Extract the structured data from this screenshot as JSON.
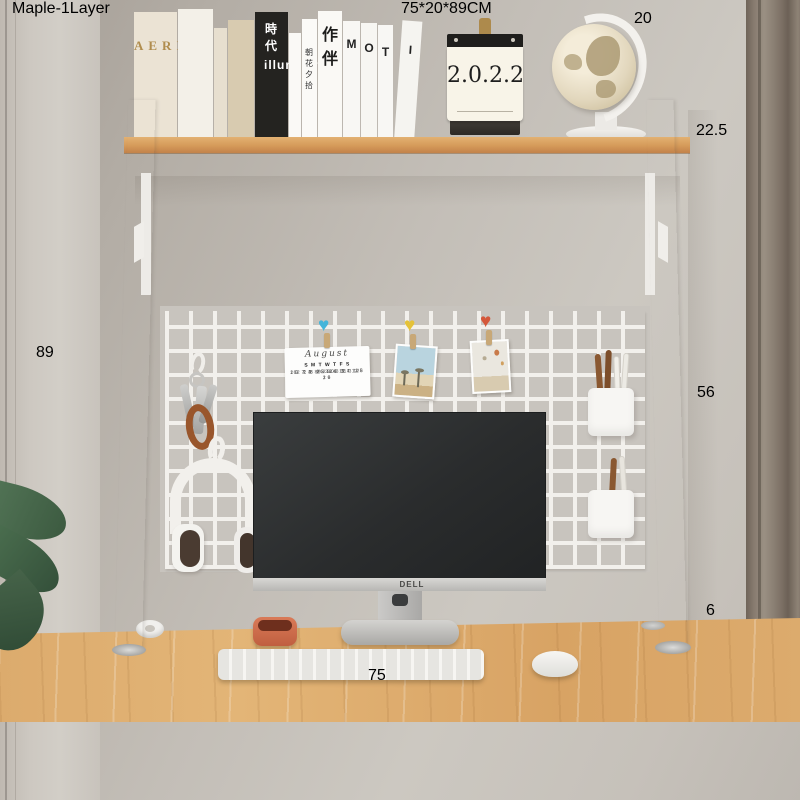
{
  "banner": {
    "variant_label": "Maple-1Layer",
    "size_label": "75*20*89CM"
  },
  "dimensions": {
    "width": "75",
    "depth": "20",
    "total_height": "89",
    "upper_height": "22.5",
    "middle_height": "56",
    "foot_height": "6"
  },
  "shelf_items": {
    "monitor_brand": "DELL",
    "desk_calendar_year": "2.0.2.2",
    "books": {
      "aerin": "AERIN",
      "black_spine_cjk": "時代",
      "black_spine_latin": "illuminate",
      "zhaohua": "朝花夕拾",
      "zuoban": "作伴",
      "letter_m": "M",
      "letter_o": "O",
      "letter_t": "T",
      "letter_i": "I"
    }
  },
  "grid_calendar": {
    "month": "August",
    "days_header": "S M T W T F S",
    "weeks": [
      "1 2 3 4 5",
      "6 7 8 9 10 11 12",
      "13 14 15 16 17 18 19",
      "20 21 22 23 24 25 26",
      "27 28 29 30 31"
    ]
  },
  "colors": {
    "banner_blue": "#2f6aa4",
    "dimension_blue": "#2b5f93",
    "heart_clip_blue": "#45b5da",
    "heart_clip_yellow": "#e5c238",
    "heart_clip_red": "#d4573a",
    "desk_wood": "#dcab6d",
    "shelf_wood_edge": "#cf9455",
    "frame_white": "#f6f5f2"
  }
}
